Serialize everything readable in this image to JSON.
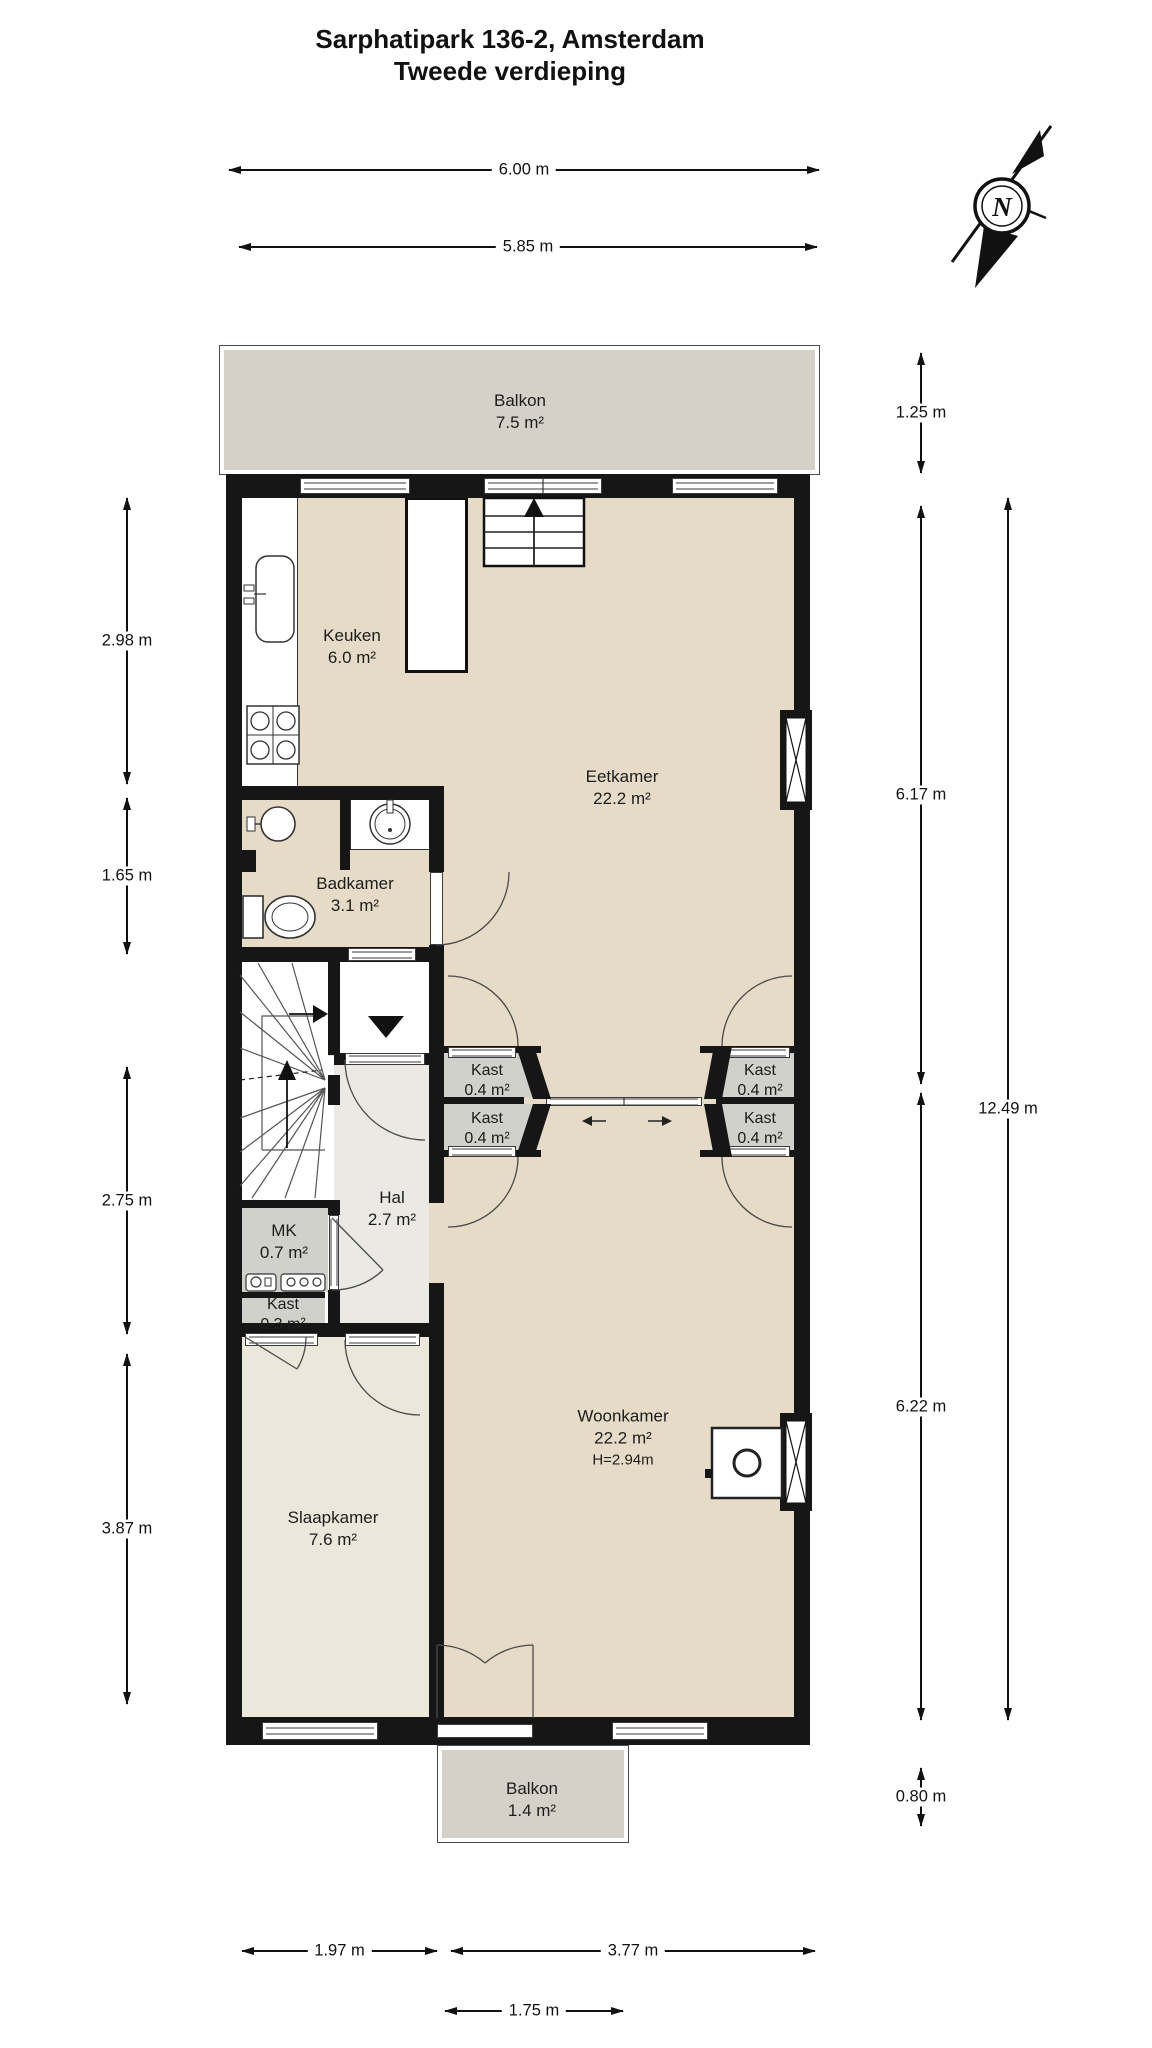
{
  "title": {
    "line1": "Sarphatipark 136-2, Amsterdam",
    "line2": "Tweede verdieping"
  },
  "compass": {
    "label": "N"
  },
  "rooms": {
    "balkon_top": {
      "name": "Balkon",
      "area": "7.5 m²"
    },
    "keuken": {
      "name": "Keuken",
      "area": "6.0 m²"
    },
    "eetkamer": {
      "name": "Eetkamer",
      "area": "22.2 m²"
    },
    "badkamer": {
      "name": "Badkamer",
      "area": "3.1 m²"
    },
    "kast_links_boven": {
      "name": "Kast",
      "area": "0.4 m²"
    },
    "kast_links_onder": {
      "name": "Kast",
      "area": "0.4 m²"
    },
    "kast_rechts_boven": {
      "name": "Kast",
      "area": "0.4 m²"
    },
    "kast_rechts_onder": {
      "name": "Kast",
      "area": "0.4 m²"
    },
    "hal": {
      "name": "Hal",
      "area": "2.7 m²"
    },
    "mk": {
      "name": "MK",
      "area": "0.7 m²"
    },
    "kast_klein": {
      "name": "Kast",
      "area": "0.3 m²"
    },
    "slaapkamer": {
      "name": "Slaapkamer",
      "area": "7.6 m²"
    },
    "woonkamer": {
      "name": "Woonkamer",
      "area": "22.2 m²",
      "height": "H=2.94m"
    },
    "balkon_onder": {
      "name": "Balkon",
      "area": "1.4 m²"
    }
  },
  "dimensions": {
    "top_outer": "6.00 m",
    "top_inner": "5.85 m",
    "left_1": "2.98 m",
    "left_2": "1.65 m",
    "left_3": "2.75 m",
    "left_4": "3.87 m",
    "right_1": "1.25 m",
    "right_2": "6.17 m",
    "right_3": "6.22 m",
    "right_4": "0.80 m",
    "right_total": "12.49 m",
    "bottom_1": "1.97 m",
    "bottom_2": "3.77 m",
    "bottom_3": "1.75 m"
  },
  "colors": {
    "floor_beige": "#e5dbc7",
    "floor_hal": "#eae9e3",
    "floor_slaapkamer": "#ebe7db",
    "closet_gray": "#d0d1ca",
    "balcony_gray": "#d5d1c8",
    "wall_black": "#161616",
    "line_dark": "#3b3b3b",
    "accent_text": "#1c1c1c"
  }
}
